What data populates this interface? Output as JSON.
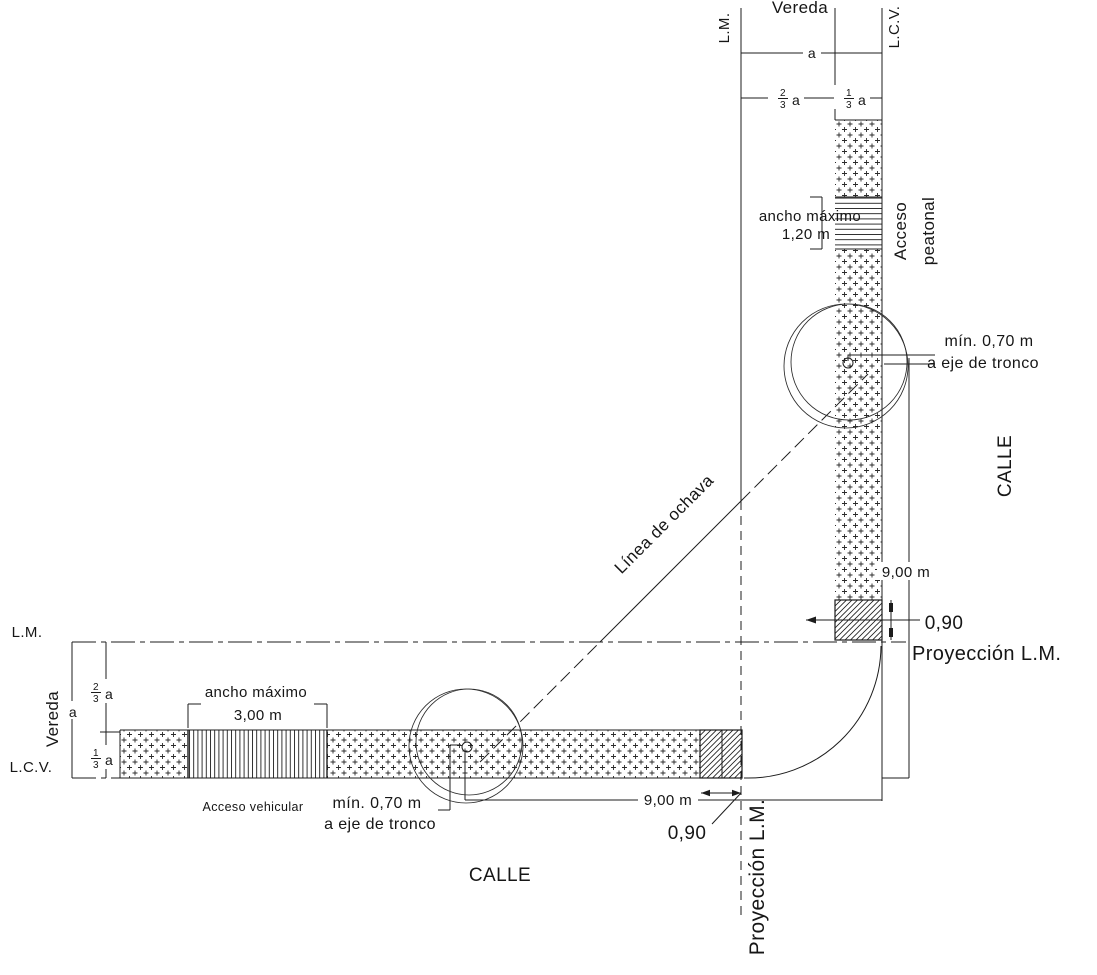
{
  "drawing": {
    "type": "municipal-sidewalk-corner-plan",
    "street_label": "CALLE",
    "sidewalk_label": "Vereda",
    "labels": {
      "lm": "L.M.",
      "lcv": "L.C.V.",
      "proyeccion_lm": "Proyección L.M.",
      "linea_ochava": "Línea de ochava",
      "acceso_peatonal_line1": "Acceso",
      "acceso_peatonal_line2": "peatonal",
      "acceso_vehicular": "Acceso vehicular",
      "ancho_maximo": "ancho máximo",
      "min_tronco_line1": "mín. 0,70 m",
      "min_tronco_line2": "a eje de tronco"
    },
    "dimensions": {
      "a": "a",
      "frac_23_num": "2",
      "frac_13_num": "1",
      "frac_den": "3",
      "ancho_peatonal": "1,20 m",
      "ancho_vehicular": "3,00 m",
      "dist_arbol_esquina": "9,00 m",
      "franja_esquina": "0,90"
    },
    "colors": {
      "line": "#1c1c1c",
      "background": "#ffffff"
    }
  }
}
